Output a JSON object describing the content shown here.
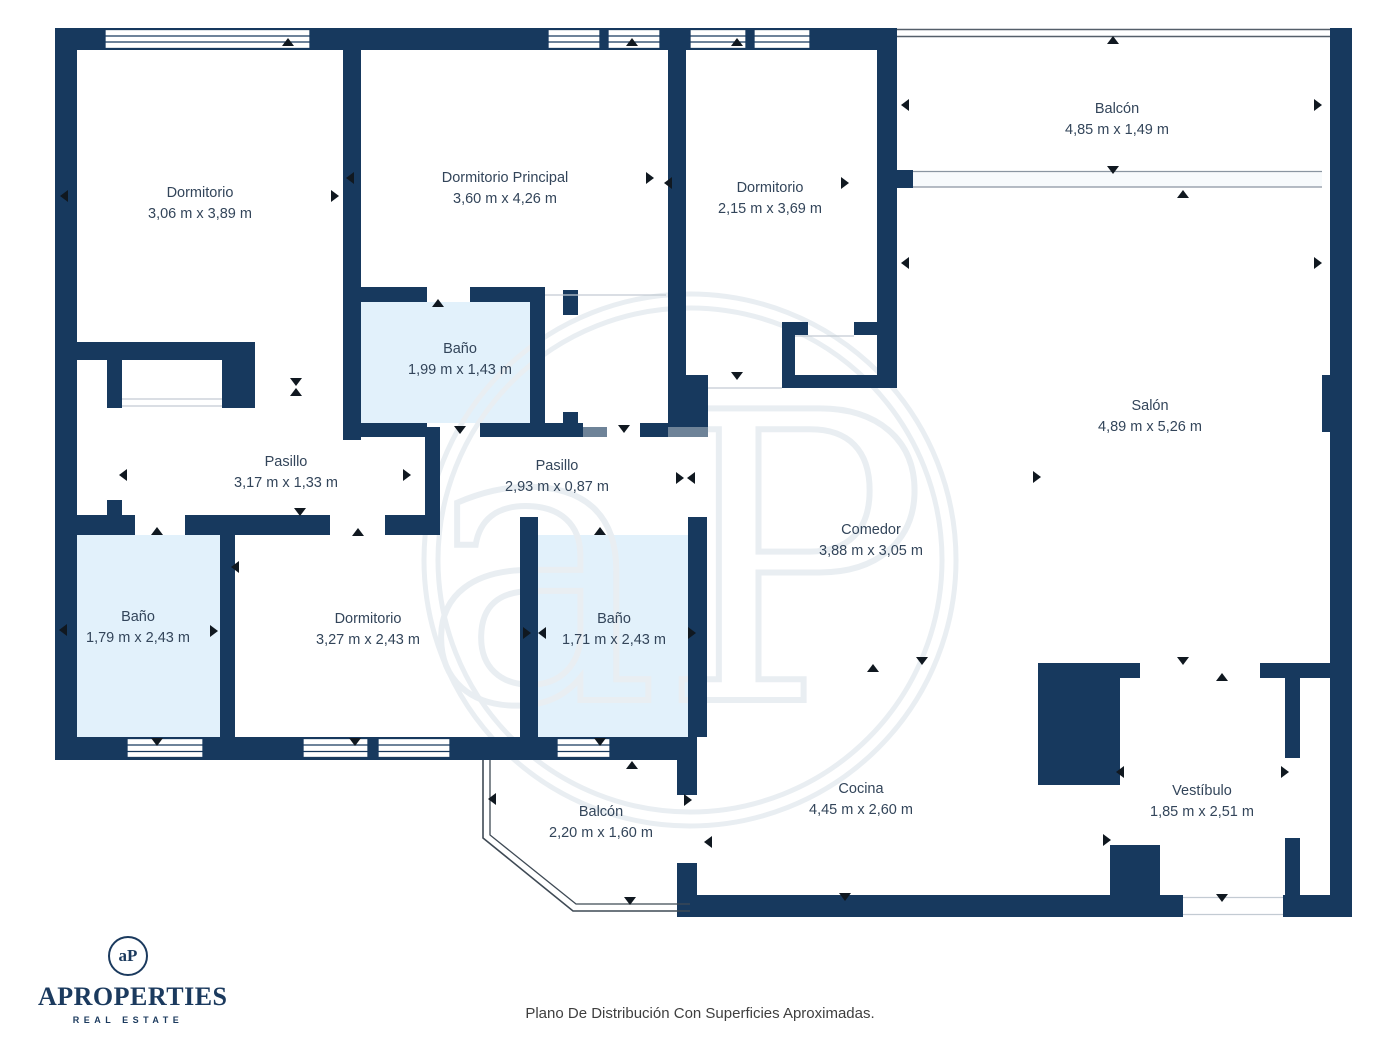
{
  "plan": {
    "rooms": [
      {
        "id": "dormitorio-1",
        "name": "Dormitorio",
        "dims": "3,06 m x 3,89 m"
      },
      {
        "id": "dormitorio-principal",
        "name": "Dormitorio Principal",
        "dims": "3,60 m x 4,26 m"
      },
      {
        "id": "dormitorio-2",
        "name": "Dormitorio",
        "dims": "2,15 m x 3,69 m"
      },
      {
        "id": "balcon-superior",
        "name": "Balcón",
        "dims": "4,85 m x 1,49 m"
      },
      {
        "id": "salon",
        "name": "Salón",
        "dims": "4,89 m x 5,26 m"
      },
      {
        "id": "bano-1",
        "name": "Baño",
        "dims": "1,99 m x 1,43 m"
      },
      {
        "id": "pasillo-1",
        "name": "Pasillo",
        "dims": "3,17 m x 1,33 m"
      },
      {
        "id": "pasillo-2",
        "name": "Pasillo",
        "dims": "2,93 m x 0,87 m"
      },
      {
        "id": "comedor",
        "name": "Comedor",
        "dims": "3,88 m x 3,05 m"
      },
      {
        "id": "bano-2",
        "name": "Baño",
        "dims": "1,79 m x 2,43 m"
      },
      {
        "id": "dormitorio-3",
        "name": "Dormitorio",
        "dims": "3,27 m x 2,43 m"
      },
      {
        "id": "bano-3",
        "name": "Baño",
        "dims": "1,71 m x 2,43 m"
      },
      {
        "id": "balcon-inferior",
        "name": "Balcón",
        "dims": "2,20 m x 1,60 m"
      },
      {
        "id": "cocina",
        "name": "Cocina",
        "dims": "4,45 m x 2,60 m"
      },
      {
        "id": "vestibulo",
        "name": "Vestíbulo",
        "dims": "1,85 m x 2,51 m"
      }
    ]
  },
  "watermark": {
    "monogram": "aP"
  },
  "branding": {
    "logo_monogram": "aP",
    "logo_name": "APROPERTIES",
    "logo_tagline": "REAL ESTATE"
  },
  "footer": {
    "caption": "Plano De Distribución Con Superficies Aproximadas."
  },
  "colors": {
    "wall": "#17395E",
    "bath_fill": "#E2F1FB",
    "slate_accent": "#6E8398",
    "label_text": "#33455A",
    "arrow": "#101820",
    "watermark": "#E9EEF2",
    "logo_navy": "#1B3A5E",
    "footer_text": "#3F3F3F"
  }
}
